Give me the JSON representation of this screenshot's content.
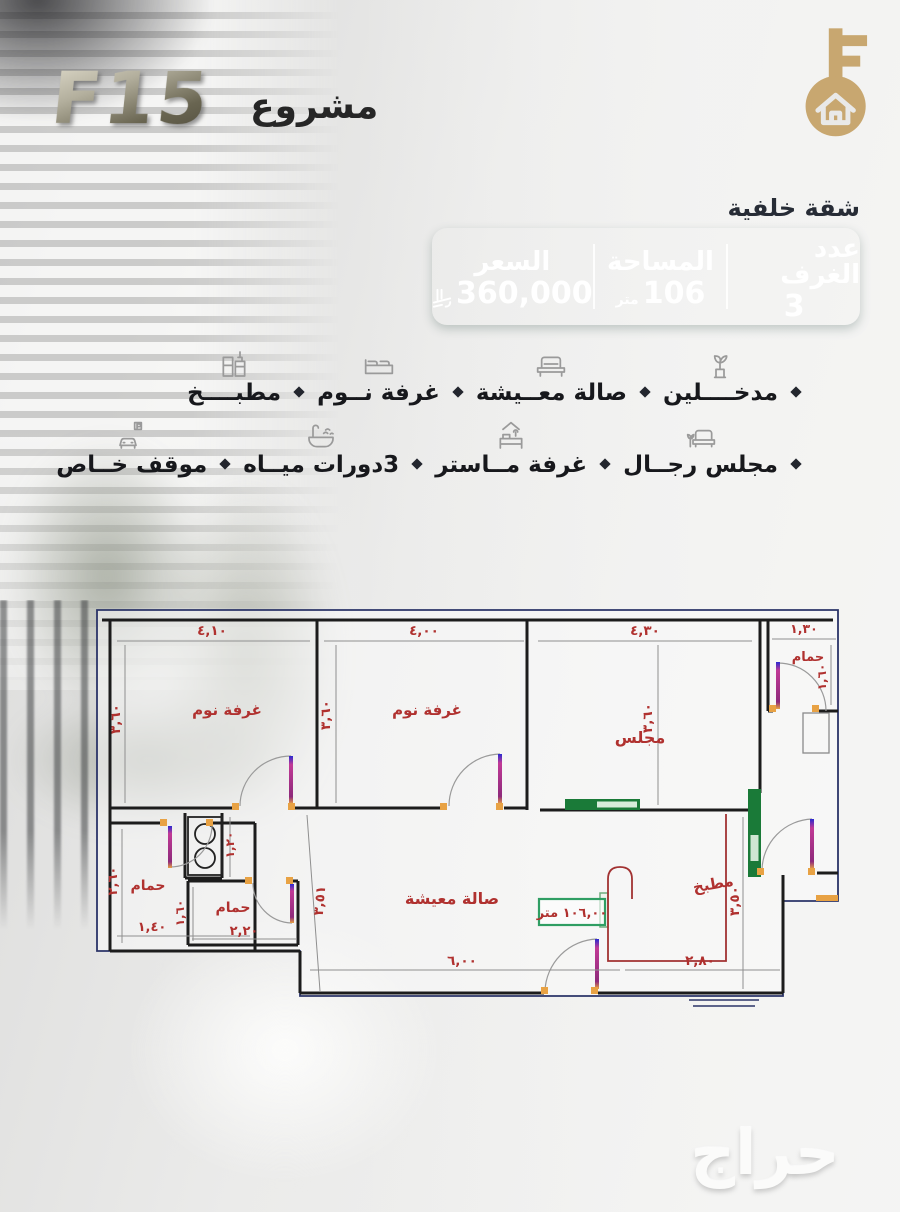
{
  "header": {
    "logo": "F15",
    "project_word": "مشروع"
  },
  "unit": {
    "label": "شقة خلفية"
  },
  "stats": {
    "rooms_label": "عدد الغرف",
    "rooms_value": "3",
    "area_label": "المساحة",
    "area_value": "106",
    "area_unit": "متر",
    "price_label": "السعر",
    "price_value": "360,000",
    "price_currency_icon": "saudi-riyal-symbol"
  },
  "features": {
    "row1": [
      {
        "label": "مدخــــلين",
        "icon": "entrance-plant-icon"
      },
      {
        "label": "صالة معــيشة",
        "icon": "sofa-icon"
      },
      {
        "label": "غرفة نــوم",
        "icon": "bed-icon"
      },
      {
        "label": "مطبــــخ",
        "icon": "kitchen-icon"
      }
    ],
    "row2": [
      {
        "label": "مجلس رجــال",
        "icon": "majlis-sofa-icon"
      },
      {
        "label": "غرفة مــاستر",
        "icon": "master-bed-icon"
      },
      {
        "label": "3دورات ميــاه",
        "icon": "bathtub-icon"
      },
      {
        "label": "موقف خــاص",
        "icon": "parking-icon"
      }
    ]
  },
  "floorplan": {
    "labels": {
      "bedroom1": "غرفة نوم",
      "bedroom2": "غرفة نوم",
      "majlis": "مجلس",
      "bath_top": "حمام",
      "bath_left": "حمام",
      "bath_mid": "حمام",
      "kitchen": "مطبخ",
      "living": "صالة معيشة"
    },
    "dims": {
      "bed1_w": "٤,١٠",
      "bed1_h": "٣,٦٠",
      "bed2_w": "٤,٠٠",
      "bed2_h": "٣,٦٠",
      "majlis_w": "٤,٣٠",
      "majlis_h": "٣,٦٠",
      "bath_top_w": "١,٣٠",
      "bath_top_h": "١,٦٠",
      "bath_left_w": "١,٤٠",
      "bath_left_h": "٢,٦٠",
      "wc_h": "١,٢٠",
      "bath_mid_w": "٢,٢٠",
      "bath_mid_h": "١,٦٠",
      "living_w": "٦,٠٠",
      "living_diag": "٣,٥١",
      "kitchen_w": "٢,٨٠",
      "kitchen_h": "٣,٥٠"
    },
    "area_badge": "١٠٦,٠٠ متر"
  },
  "watermark": "حراج",
  "colors": {
    "teal_dark": "#186059",
    "teal_light": "#7bab9d",
    "gold": "#c8a770",
    "plan_red": "#b0312f",
    "plan_navy": "#2b3468",
    "plan_green": "#1a7a38",
    "door_magenta": "#b5338a",
    "jamb_orange": "#e8a244"
  }
}
